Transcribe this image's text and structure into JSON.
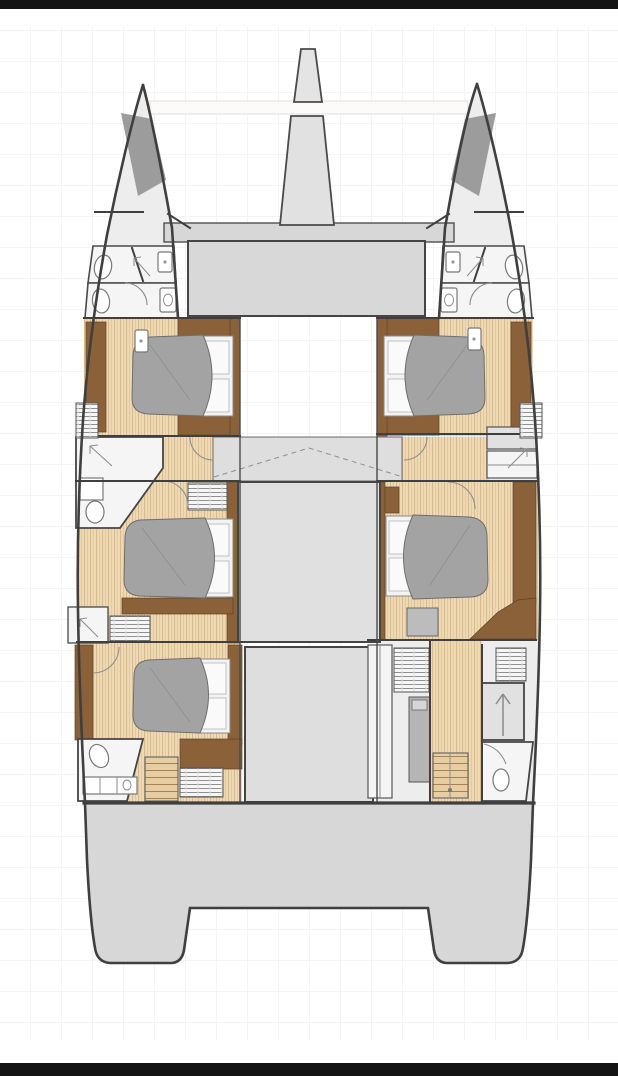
{
  "scene": {
    "type": "catamaran-deck-plan",
    "description": "Top-down architectural floor plan of a twin-hull sailing catamaran lower deck",
    "orientation": "bow-up"
  },
  "palette": {
    "frameBar": "#141414",
    "background": "#ffffff",
    "grid": "#f1eeec",
    "outline": "#3f3f3f",
    "hullFill": "#ededed",
    "deckGray": "#d7d7d7",
    "roomGray": "#e1e1e1",
    "panelWhite": "#f5f5f5",
    "fixtureWhite": "#ffffff",
    "duvetGray": "#a3a3a3",
    "lockerGray": "#9c9c9c",
    "applianceGray": "#b5b5b5",
    "woodLight": "#eed9b4",
    "woodStripe": "#d9ba8c",
    "woodMid": "#e7cda4",
    "brownDark": "#8a6138"
  },
  "inventory": {
    "hulls": 2,
    "double_beds": 5,
    "toilets": 6,
    "showers": 4,
    "staircases": 2,
    "trampoline_bays": 2,
    "bowsprit": 1,
    "anchor_locker": 1,
    "saloon_modules": 3,
    "deck_hatches": 4,
    "wardrobes": 6
  }
}
